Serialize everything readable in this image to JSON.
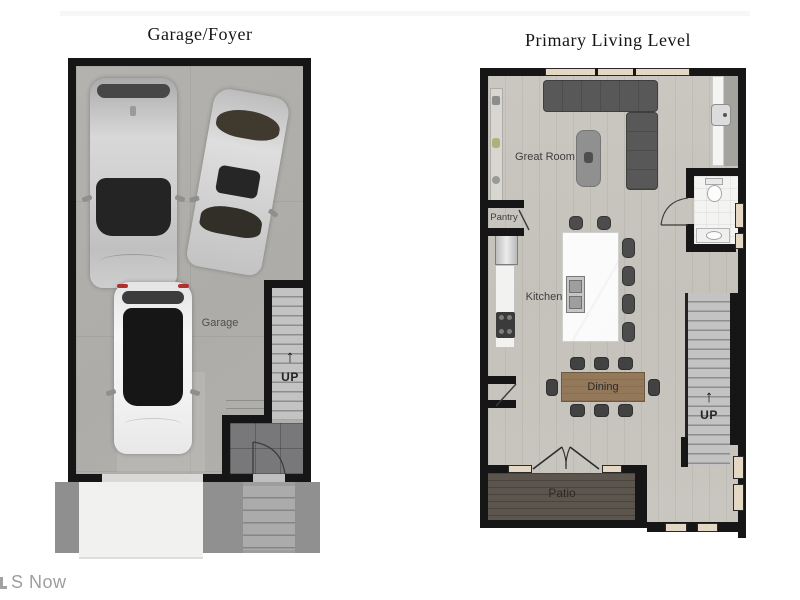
{
  "page": {
    "watermark": "S Now"
  },
  "left_plan": {
    "title": "Garage/Foyer",
    "garage_label": "Garage",
    "stairs": {
      "up_label": "UP",
      "arrow": "↑"
    }
  },
  "right_plan": {
    "title": "Primary Living Level",
    "rooms": {
      "great_room": "Great Room",
      "pantry": "Pantry",
      "kitchen": "Kitchen",
      "dining": "Dining",
      "patio": "Patio"
    },
    "stairs": {
      "up_label": "UP",
      "arrow": "↑"
    }
  },
  "colors": {
    "wall": "#161616",
    "concrete_floor": "#b1afab",
    "wood_floor": "#c9c6c0",
    "tile_floor": "#78787b",
    "deck": "#5c554d",
    "window_fill": "#e4d7c3",
    "sofa": "#575757",
    "island": "#fafafa",
    "taillight": "#b03030"
  }
}
